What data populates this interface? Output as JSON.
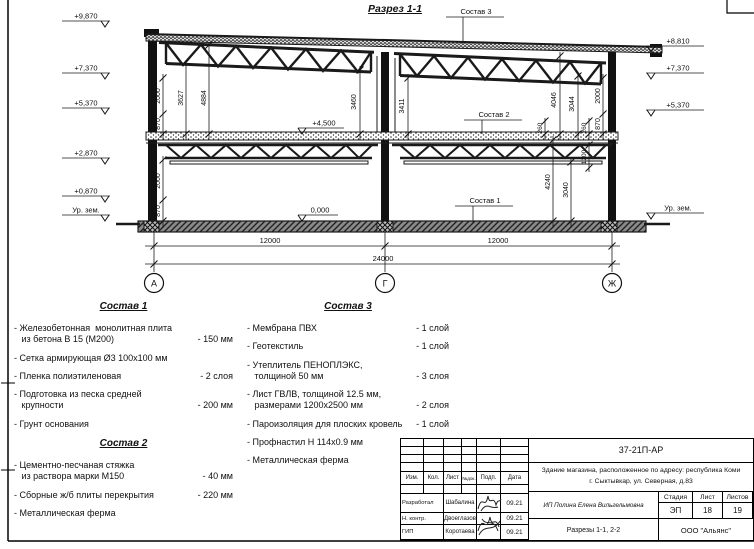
{
  "title": "Разрез 1-1",
  "drawing": {
    "axes": {
      "a": "А",
      "g": "Г",
      "j": "Ж"
    },
    "spans": {
      "s1": "12000",
      "s2": "12000",
      "total": "24000"
    },
    "elev": {
      "l1": "+9,870",
      "l2": "+7,370",
      "l3": "+5,370",
      "l4": "+2,870",
      "l5": "+0,870",
      "lg": "Ур. зем.",
      "r1": "+8,810",
      "r2": "+7,370",
      "r3": "+5,370",
      "rg": "Ур. зем.",
      "floor2": "+4,500",
      "floor0": "0,000"
    },
    "leaders": {
      "s1": "Состав 1",
      "s2": "Состав 2",
      "s3": "Состав 3"
    },
    "dims": {
      "c2000a": "2000",
      "c870a": "870",
      "d3627": "3627",
      "d4884": "4884",
      "d3460": "3460",
      "d3411": "3411",
      "d4046": "4046",
      "d3044": "3044",
      "c2000b": "2000",
      "c870b": "870",
      "d260a": "260",
      "d260b": "260",
      "c2000c": "2000",
      "c870c": "870",
      "d4240": "4240",
      "d3040": "3040",
      "d1200": "1200"
    }
  },
  "lists": [
    {
      "title": "Состав 1",
      "items": [
        {
          "name": "- Железобетонная  монолитная плита\n   из бетона В 15 (М200)",
          "value": "- 150 мм"
        },
        {
          "name": "- Сетка армирующая Ø3 100х100 мм",
          "value": ""
        },
        {
          "name": "- Пленка полиэтиленовая",
          "value": "-  2 слоя"
        },
        {
          "name": "- Подготовка из песка средней\n   крупности",
          "value": "- 200 мм"
        },
        {
          "name": "- Грунт основания",
          "value": ""
        }
      ]
    },
    {
      "title": "Состав 2",
      "items": [
        {
          "name": "- Цементно-песчаная стяжка\n   из раствора марки М150",
          "value": "- 40 мм"
        },
        {
          "name": "- Сборные ж/б плиты перекрытия",
          "value": "- 220 мм"
        },
        {
          "name": "- Металлическая ферма",
          "value": ""
        }
      ]
    },
    {
      "title": "Состав 3",
      "items": [
        {
          "name": "- Мембрана ПВХ",
          "value": "- 1 слой"
        },
        {
          "name": "- Геотекстиль",
          "value": "- 1 слой"
        },
        {
          "name": "- Утеплитель ПЕНОПЛЭКС,\n   толщиной 50 мм",
          "value": "- 3 слоя"
        },
        {
          "name": "- Лист ГВЛВ, толщиной 12.5 мм,\n   размерами 1200х2500 мм",
          "value": "- 2 слоя"
        },
        {
          "name": "- Пароизоляция для плоских кровель",
          "value": "- 1 слой"
        },
        {
          "name": "- Профнастил Н 114х0.9 мм",
          "value": ""
        },
        {
          "name": "- Металлическая ферма",
          "value": ""
        }
      ]
    }
  ],
  "titleblock": {
    "doc_number": "37-21П-АР",
    "object": "Здание магазина, расположенное по адресу: республика Коми\nг. Сыктывкар, ул. Северная, д.83",
    "cols": {
      "izm": "Изм.",
      "kol": "Кол.",
      "list": "Лист",
      "ndoc": "№док.",
      "podp": "Подп.",
      "data": "Дата"
    },
    "rows": [
      {
        "role": "Разработал",
        "name": "Шабалина",
        "date": "09.21"
      },
      {
        "role": "Н. контр.",
        "name": "Двоеглазов",
        "date": "09.21"
      },
      {
        "role": "ГИП",
        "name": "Коротаева",
        "date": "09.21"
      }
    ],
    "designer": "ИП Полина Елена Вильгельмовна",
    "stage_label": "Стадия",
    "sheet_label": "Лист",
    "sheets_label": "Листов",
    "stage": "ЭП",
    "sheet": "18",
    "sheets": "19",
    "sheet_title": "Разрезы 1-1, 2-2",
    "org": "ООО \"Альянс\""
  }
}
